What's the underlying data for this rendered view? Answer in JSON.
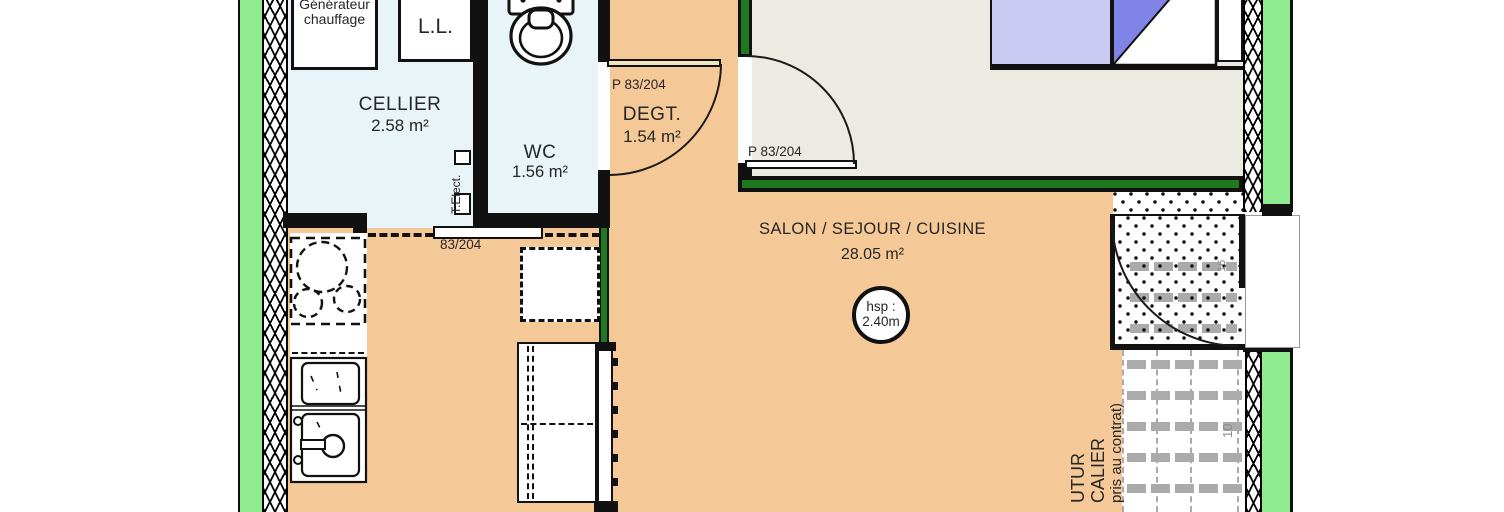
{
  "floorplan": {
    "rooms": {
      "cellier": {
        "name": "CELLIER",
        "area": "2.58 m²"
      },
      "wc": {
        "name": "WC",
        "area": "1.56 m²"
      },
      "degt": {
        "name": "DEGT.",
        "area": "1.54 m²"
      },
      "salon": {
        "name": "SALON / SEJOUR / CUISINE",
        "area": "28.05 m²"
      }
    },
    "equipment": {
      "generator_line1": "Générateur",
      "generator_line2": "chauffage",
      "washing_machine": "L.L.",
      "electrical_panel": "T.Elect."
    },
    "doors": {
      "cellier_sliding": "83/204",
      "degt": "P 83/204",
      "bedroom": "P 83/204"
    },
    "annotations": {
      "ceiling_height_line1": "hsp :",
      "ceiling_height_line2": "2.40m",
      "stair_note_line1": "UTUR",
      "stair_note_line2": "CALIER",
      "stair_note_line3": "pris au contrat)",
      "stair_dim_upper": "16",
      "stair_dim_lower": "10"
    },
    "colors": {
      "exterior_wall_green": "#90EC90",
      "interior_wall_green": "#1F7A1F",
      "floor_salon": "#F5C997",
      "floor_cellier_wc": "#E8F4F7",
      "floor_bedroom": "#EBEBE3",
      "bed_blanket": "#C9C9F1",
      "bed_fold": "#8184E7",
      "stair_gray": "#ABABAB"
    }
  }
}
